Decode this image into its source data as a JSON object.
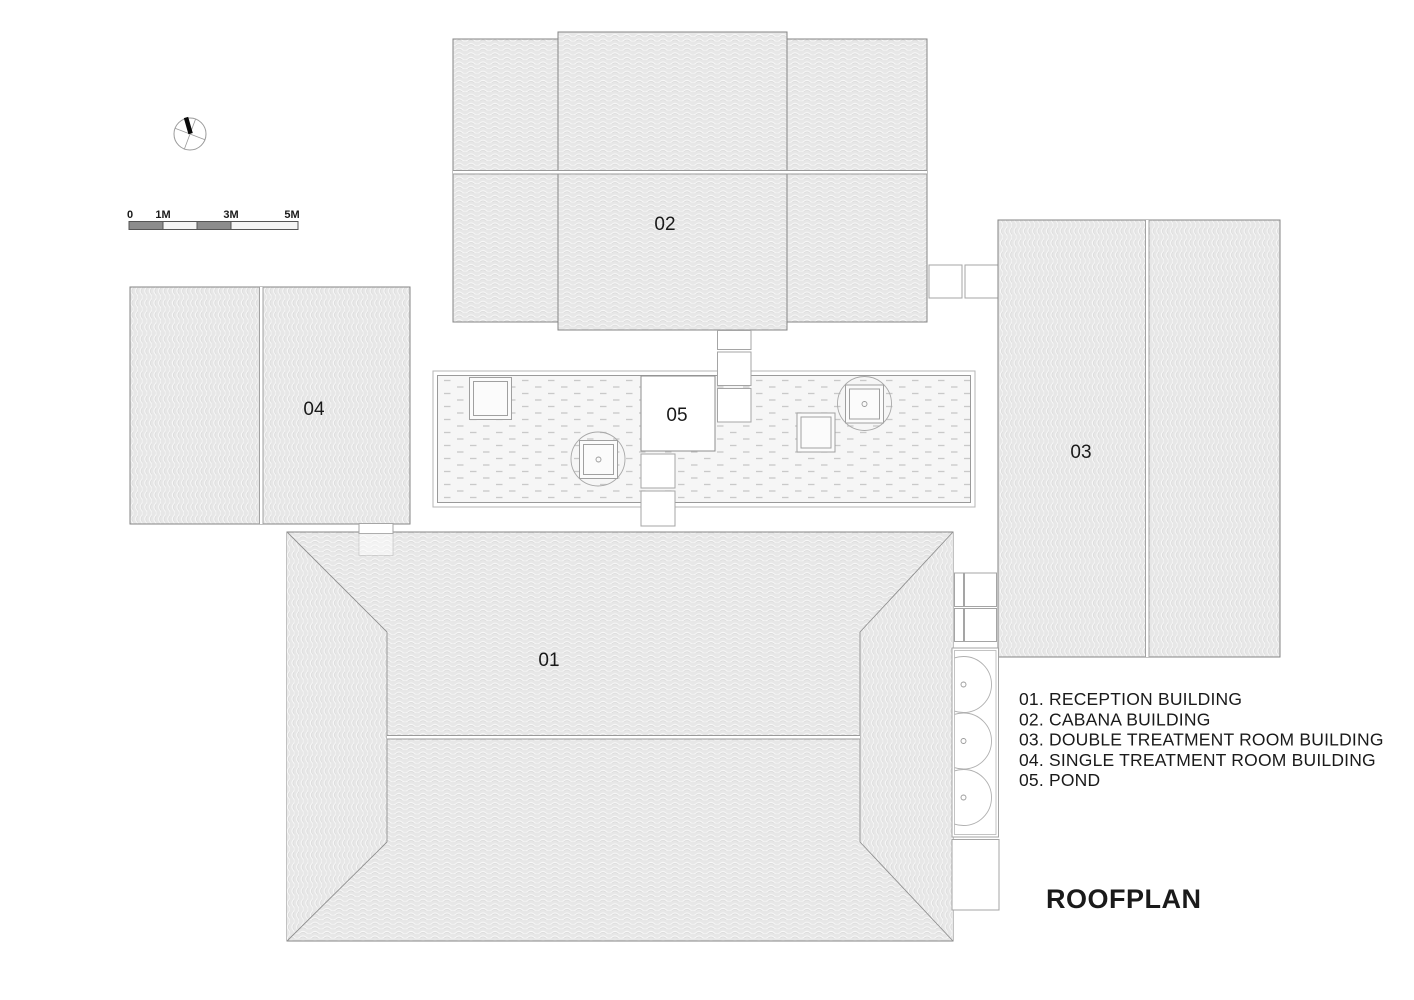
{
  "title": "ROOFPLAN",
  "labels": {
    "b01": "01",
    "b02": "02",
    "b03": "03",
    "b04": "04",
    "b05": "05"
  },
  "legend": [
    "01. RECEPTION BUILDING",
    "02. CABANA BUILDING",
    "03. DOUBLE TREATMENT ROOM BUILDING",
    "04. SINGLE TREATMENT ROOM BUILDING",
    "05. POND"
  ],
  "scale_bar": {
    "labels": [
      "0",
      "1M",
      "3M",
      "5M"
    ]
  },
  "colors": {
    "roof_fill": "#e7e7e7",
    "outline": "#858585",
    "pond_fill": "#f6f6f6",
    "accent_dark": "#8c8c8c",
    "text": "#1a1a1a"
  }
}
